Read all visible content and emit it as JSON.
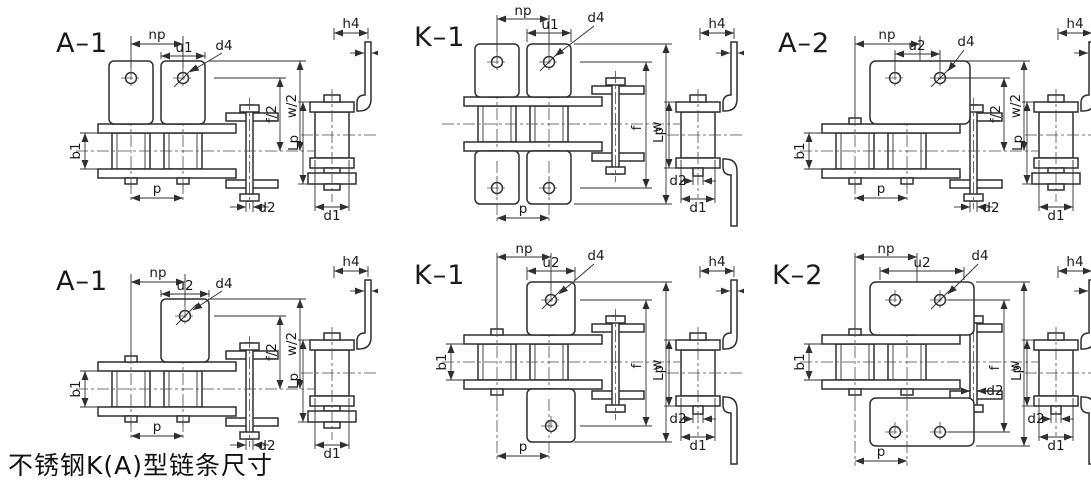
{
  "page": {
    "caption": "不锈钢K(A)型链条尺寸",
    "background": "#ffffff",
    "line_color": "#2f2f2f"
  },
  "panels": [
    {
      "id": "top-left",
      "title": "A–1",
      "attachment": "bent plate one side, two links",
      "labels": {
        "np": "np",
        "u": "u1",
        "d4": "d4",
        "f": "f/2",
        "w": "w/2",
        "b1": "b1",
        "p": "p",
        "d2": "d2",
        "d1": "d1",
        "h4": "h4",
        "lp": "Lp"
      }
    },
    {
      "id": "top-middle",
      "title": "K–1",
      "attachment": "bent plates both sides, two links",
      "labels": {
        "np": "np",
        "u": "u1",
        "d4": "d4",
        "f": "f",
        "w": "w",
        "p": "p",
        "d2": "d2",
        "d1": "d1",
        "h4": "h4",
        "lp": "Lp"
      }
    },
    {
      "id": "top-right",
      "title": "A–2",
      "attachment": "wide bent plate one side, two holes",
      "labels": {
        "np": "np",
        "u": "u2",
        "d4": "d4",
        "f": "f/2",
        "w": "w/2",
        "b1": "b1",
        "p": "p",
        "d2": "d2",
        "d1": "d1",
        "h4": "h4",
        "lp": "Lp"
      }
    },
    {
      "id": "bottom-left",
      "title": "A–1",
      "attachment": "bent plate one side, single hole",
      "labels": {
        "np": "np",
        "u": "u2",
        "d4": "d4",
        "f": "f/2",
        "w": "w/2",
        "b1": "b1",
        "p": "p",
        "d2": "d2",
        "d1": "d1",
        "h4": "h4",
        "lp": "Lp"
      }
    },
    {
      "id": "bottom-middle",
      "title": "K–1",
      "attachment": "bent plates both sides, single hole",
      "labels": {
        "np": "np",
        "u": "u2",
        "d4": "d4",
        "f": "f",
        "w": "w",
        "b1": "b1",
        "p": "p",
        "d2": "d2",
        "d1": "d1",
        "h4": "h4",
        "lp": "Lp"
      }
    },
    {
      "id": "bottom-right",
      "title": "K–2",
      "attachment": "wide bent plates both sides, two holes",
      "labels": {
        "np": "np",
        "u": "u2",
        "d4": "d4",
        "f": "f",
        "w": "w",
        "b1": "b1",
        "p": "p",
        "d2": "d2",
        "d1": "d1",
        "h4": "h4",
        "lp": "Lp"
      }
    }
  ]
}
